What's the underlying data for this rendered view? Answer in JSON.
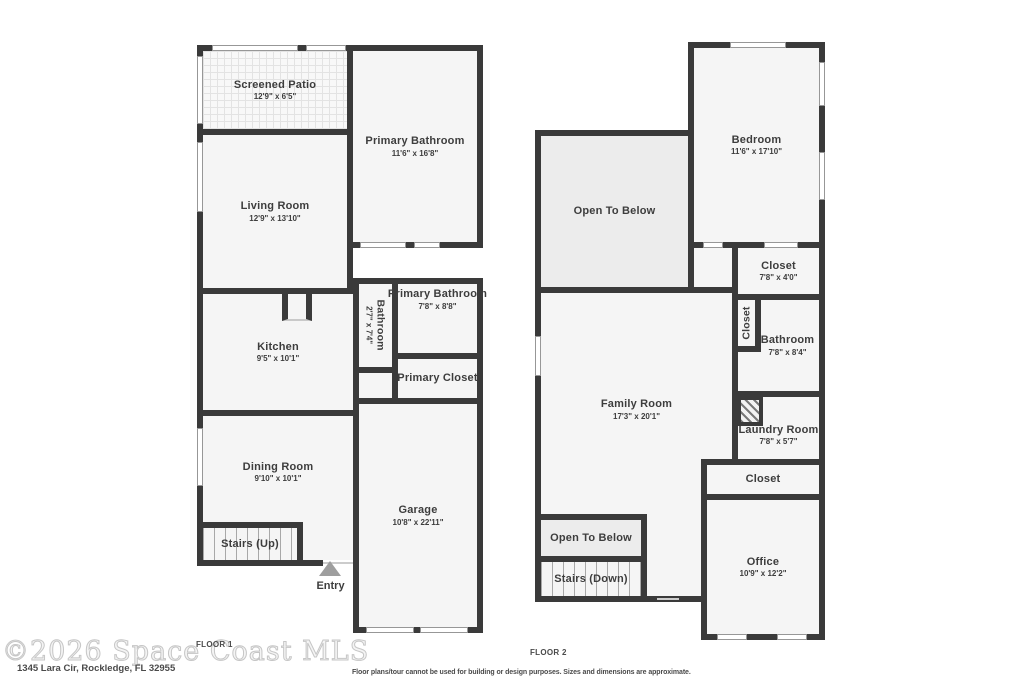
{
  "colors": {
    "wall": "#3a3a3a",
    "room_fill": "#f5f5f5",
    "open_to_below_fill": "#ececec",
    "text": "#3d3d3d",
    "watermark": "#cccccc"
  },
  "watermark": "©2026 Space Coast MLS",
  "address": "1345 Lara Cir, Rockledge, FL 32955",
  "disclaimer": "Floor plans/tour cannot be used for building or design purposes. Sizes and dimensions are approximate.",
  "floor1": {
    "caption": "FLOOR 1",
    "entry_label": "Entry",
    "rooms": [
      {
        "name": "Screened Patio",
        "dims": "12'9\" x 6'5\""
      },
      {
        "name": "Living Room",
        "dims": "12'9\" x 13'10\""
      },
      {
        "name": "Primary Bathroom",
        "dims": "11'6\" x 16'8\""
      },
      {
        "name": "Kitchen",
        "dims": "9'5\" x 10'1\""
      },
      {
        "name": "Bathroom",
        "dims": "2'7\" x 7'4\""
      },
      {
        "name": "Primary Bathroom",
        "dims": "7'8\" x 8'8\""
      },
      {
        "name": "Primary Closet",
        "dims": ""
      },
      {
        "name": "Dining Room",
        "dims": "9'10\" x 10'1\""
      },
      {
        "name": "Stairs (Up)",
        "dims": ""
      },
      {
        "name": "Garage",
        "dims": "10'8\" x 22'11\""
      }
    ]
  },
  "floor2": {
    "caption": "FLOOR 2",
    "rooms": [
      {
        "name": "Bedroom",
        "dims": "11'6\" x 17'10\""
      },
      {
        "name": "Open To Below",
        "dims": ""
      },
      {
        "name": "Closet",
        "dims": "7'8\" x 4'0\""
      },
      {
        "name": "Closet",
        "dims": ""
      },
      {
        "name": "Bathroom",
        "dims": "7'8\" x 8'4\""
      },
      {
        "name": "Family Room",
        "dims": "17'3\" x 20'1\""
      },
      {
        "name": "Laundry Room",
        "dims": "7'8\" x 5'7\""
      },
      {
        "name": "Closet",
        "dims": ""
      },
      {
        "name": "Office",
        "dims": "10'9\" x 12'2\""
      },
      {
        "name": "Open To Below",
        "dims": ""
      },
      {
        "name": "Stairs (Down)",
        "dims": ""
      }
    ]
  }
}
